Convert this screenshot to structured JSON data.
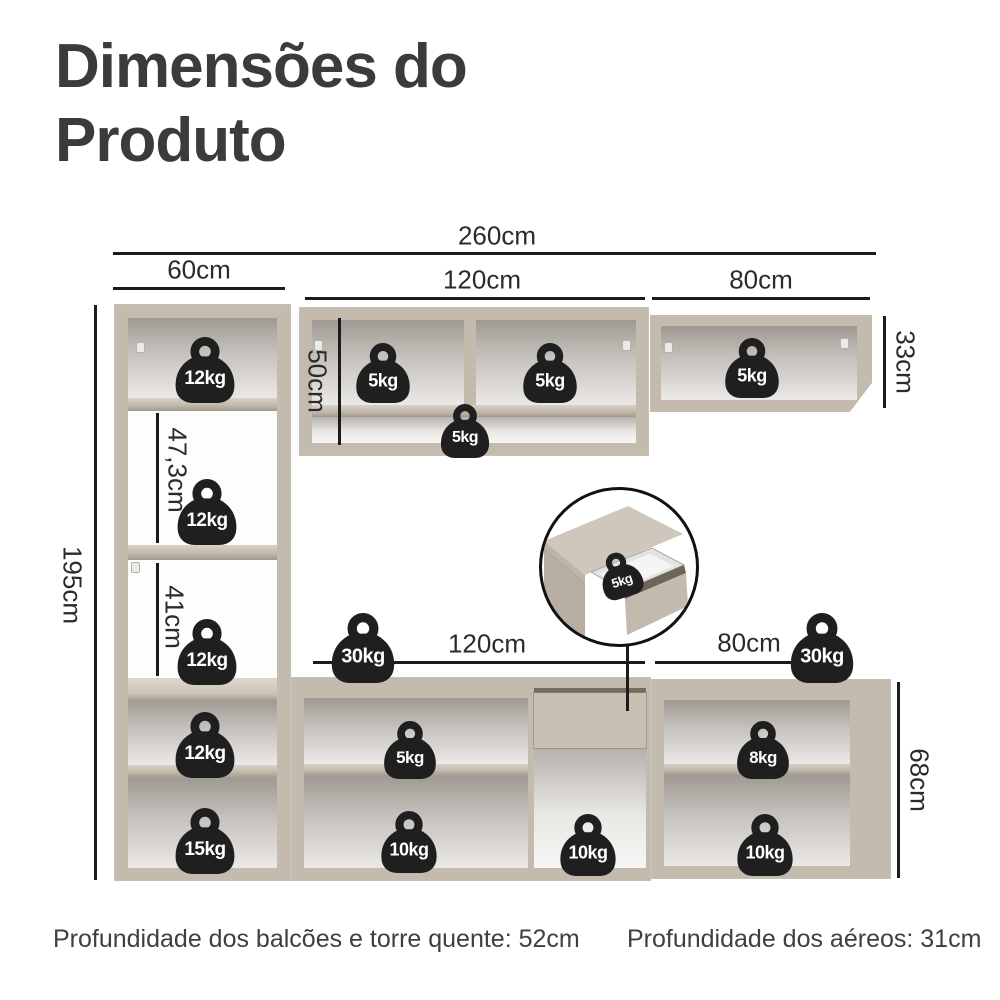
{
  "title": "Dimensões do Produto",
  "diagram": {
    "dims": {
      "total_width": "260cm",
      "tower_width": "60cm",
      "upper_mid_width": "120cm",
      "upper_right_width": "80cm",
      "upper_mid_height": "50cm",
      "upper_right_height": "33cm",
      "tower_height": "195cm",
      "tower_mid_niche_height": "47,3cm",
      "tower_lower_niche_height": "41cm",
      "base_mid_width": "120cm",
      "base_right_width": "80cm",
      "base_height": "68cm"
    },
    "weights": {
      "tower_top": "12kg",
      "tower_mid": "12kg",
      "tower_lower": "12kg",
      "tower_base_upper": "12kg",
      "tower_base_bottom": "15kg",
      "upper_mid_left": "5kg",
      "upper_mid_right": "5kg",
      "upper_mid_shelf": "5kg",
      "upper_right": "5kg",
      "drawer_detail": "5kg",
      "counter_mid": "30kg",
      "counter_right": "30kg",
      "base_mid_shelf": "5kg",
      "base_mid_bottom": "10kg",
      "base_drawer_bottom": "10kg",
      "base_right_shelf": "8kg",
      "base_right_bottom": "10kg"
    }
  },
  "footer": {
    "left": "Profundidade dos balcões e torre quente: 52cm",
    "right": "Profundidade dos aéreos: 31cm"
  },
  "colors": {
    "wood": "#c4bbaf",
    "wood_light": "#d9d1c6",
    "wood_dark": "#a2998c",
    "icon": "#1f1f1f",
    "line": "#1b1b1b",
    "text": "#3b3b3b"
  }
}
